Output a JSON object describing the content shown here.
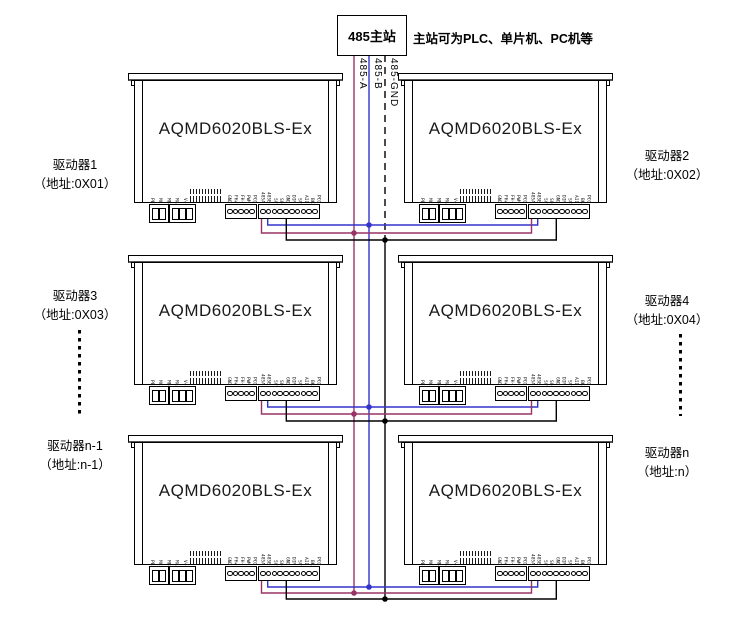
{
  "master": {
    "label": "485主站",
    "note": "主站可为PLC、单片机、PC机等"
  },
  "bus_wires": [
    {
      "name": "485-A",
      "color": "#993366",
      "dashed": false
    },
    {
      "name": "485-B",
      "color": "#3434CC",
      "dashed": false
    },
    {
      "name": "485-GND",
      "color": "#000000",
      "dashed": true
    }
  ],
  "device_model": "AQMD6020BLS-Ex",
  "drivers": [
    {
      "name": "驱动器1",
      "addr": "（地址:0X01）"
    },
    {
      "name": "驱动器2",
      "addr": "（地址:0X02）"
    },
    {
      "name": "驱动器3",
      "addr": "（地址:0X03）"
    },
    {
      "name": "驱动器4",
      "addr": "（地址:0X04）"
    },
    {
      "name": "驱动器n-1",
      "addr": "（地址:n-1）"
    },
    {
      "name": "驱动器n",
      "addr": "（地址:n）"
    }
  ],
  "pin_labels": {
    "power": [
      "PE",
      "MC",
      "MB",
      "MA",
      "V+"
    ],
    "signal5": [
      "GND",
      "FH+",
      "FH-",
      "PWM",
      "PCO"
    ],
    "signal10": [
      "485A",
      "485B",
      "5V",
      "SQ",
      "GND",
      "DIR",
      "SV",
      "AI1",
      "BK",
      "PCO"
    ]
  }
}
